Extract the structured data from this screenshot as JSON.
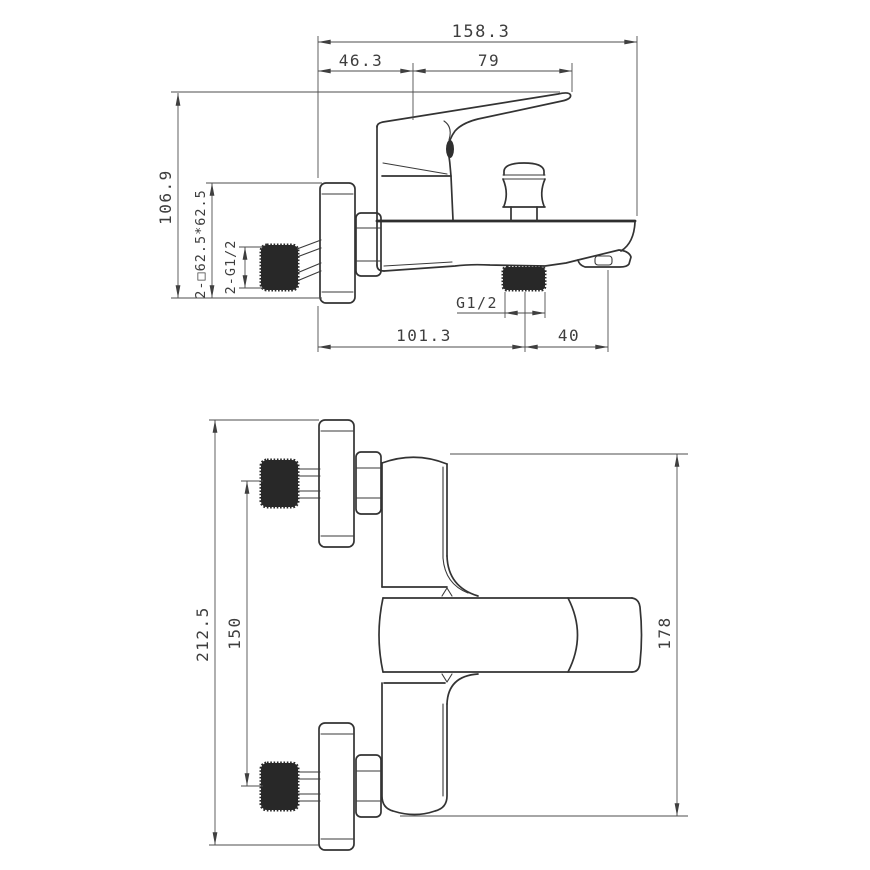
{
  "drawing": {
    "background": "#ffffff",
    "line_color": "#333333",
    "dim_color": "#4e4e4e",
    "knurl_color": "#282828"
  },
  "side_view": {
    "dims": {
      "overall_length": "158.3",
      "wall_to_handle_axis": "46.3",
      "handle_axis_to_tip": "79",
      "overall_height": "106.9",
      "escutcheon_square": "2-□62.5*62.5",
      "inlet_threads": "2-G1/2",
      "outlet_thread": "G1/2",
      "wall_to_outlet": "101.3",
      "outlet_to_spout_tip": "40"
    }
  },
  "front_view": {
    "dims": {
      "overall_height": "212.5",
      "inlet_center_spacing": "150",
      "body_height": "178"
    }
  }
}
